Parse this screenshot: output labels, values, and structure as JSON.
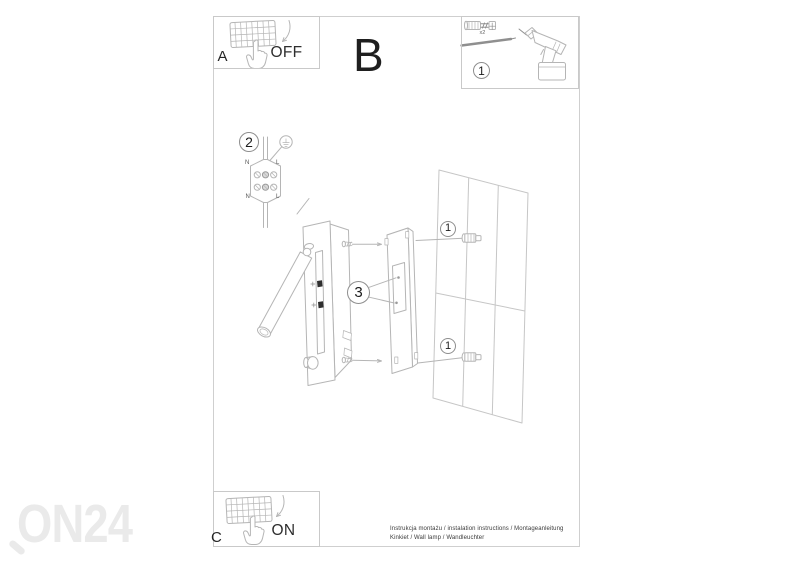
{
  "page": {
    "steps": {
      "a": {
        "label": "A",
        "switch_state": "OFF"
      },
      "b": {
        "label": "B"
      },
      "c": {
        "label": "C",
        "switch_state": "ON"
      }
    },
    "tools": {
      "step_number": "1",
      "screw_quantity": "x2"
    },
    "wiring": {
      "step_number": "2",
      "terminals": {
        "top_left": "N",
        "top_right": "L",
        "bottom_left": "N",
        "bottom_right": "L"
      }
    },
    "assembly": {
      "fixing_screws_step": "3",
      "wall_plug_top_step": "1",
      "wall_plug_bottom_step": "1"
    },
    "footer": {
      "line1": "Instrukcja montażu / instalation instructions / Montageanleitung",
      "line2": "Kinkiet / Wall lamp / Wandleuchter"
    },
    "watermark": "ON24",
    "colors": {
      "line_art": "#b5b5b5",
      "watermark": "#eaeaea",
      "text": "#2b2b2b"
    }
  }
}
